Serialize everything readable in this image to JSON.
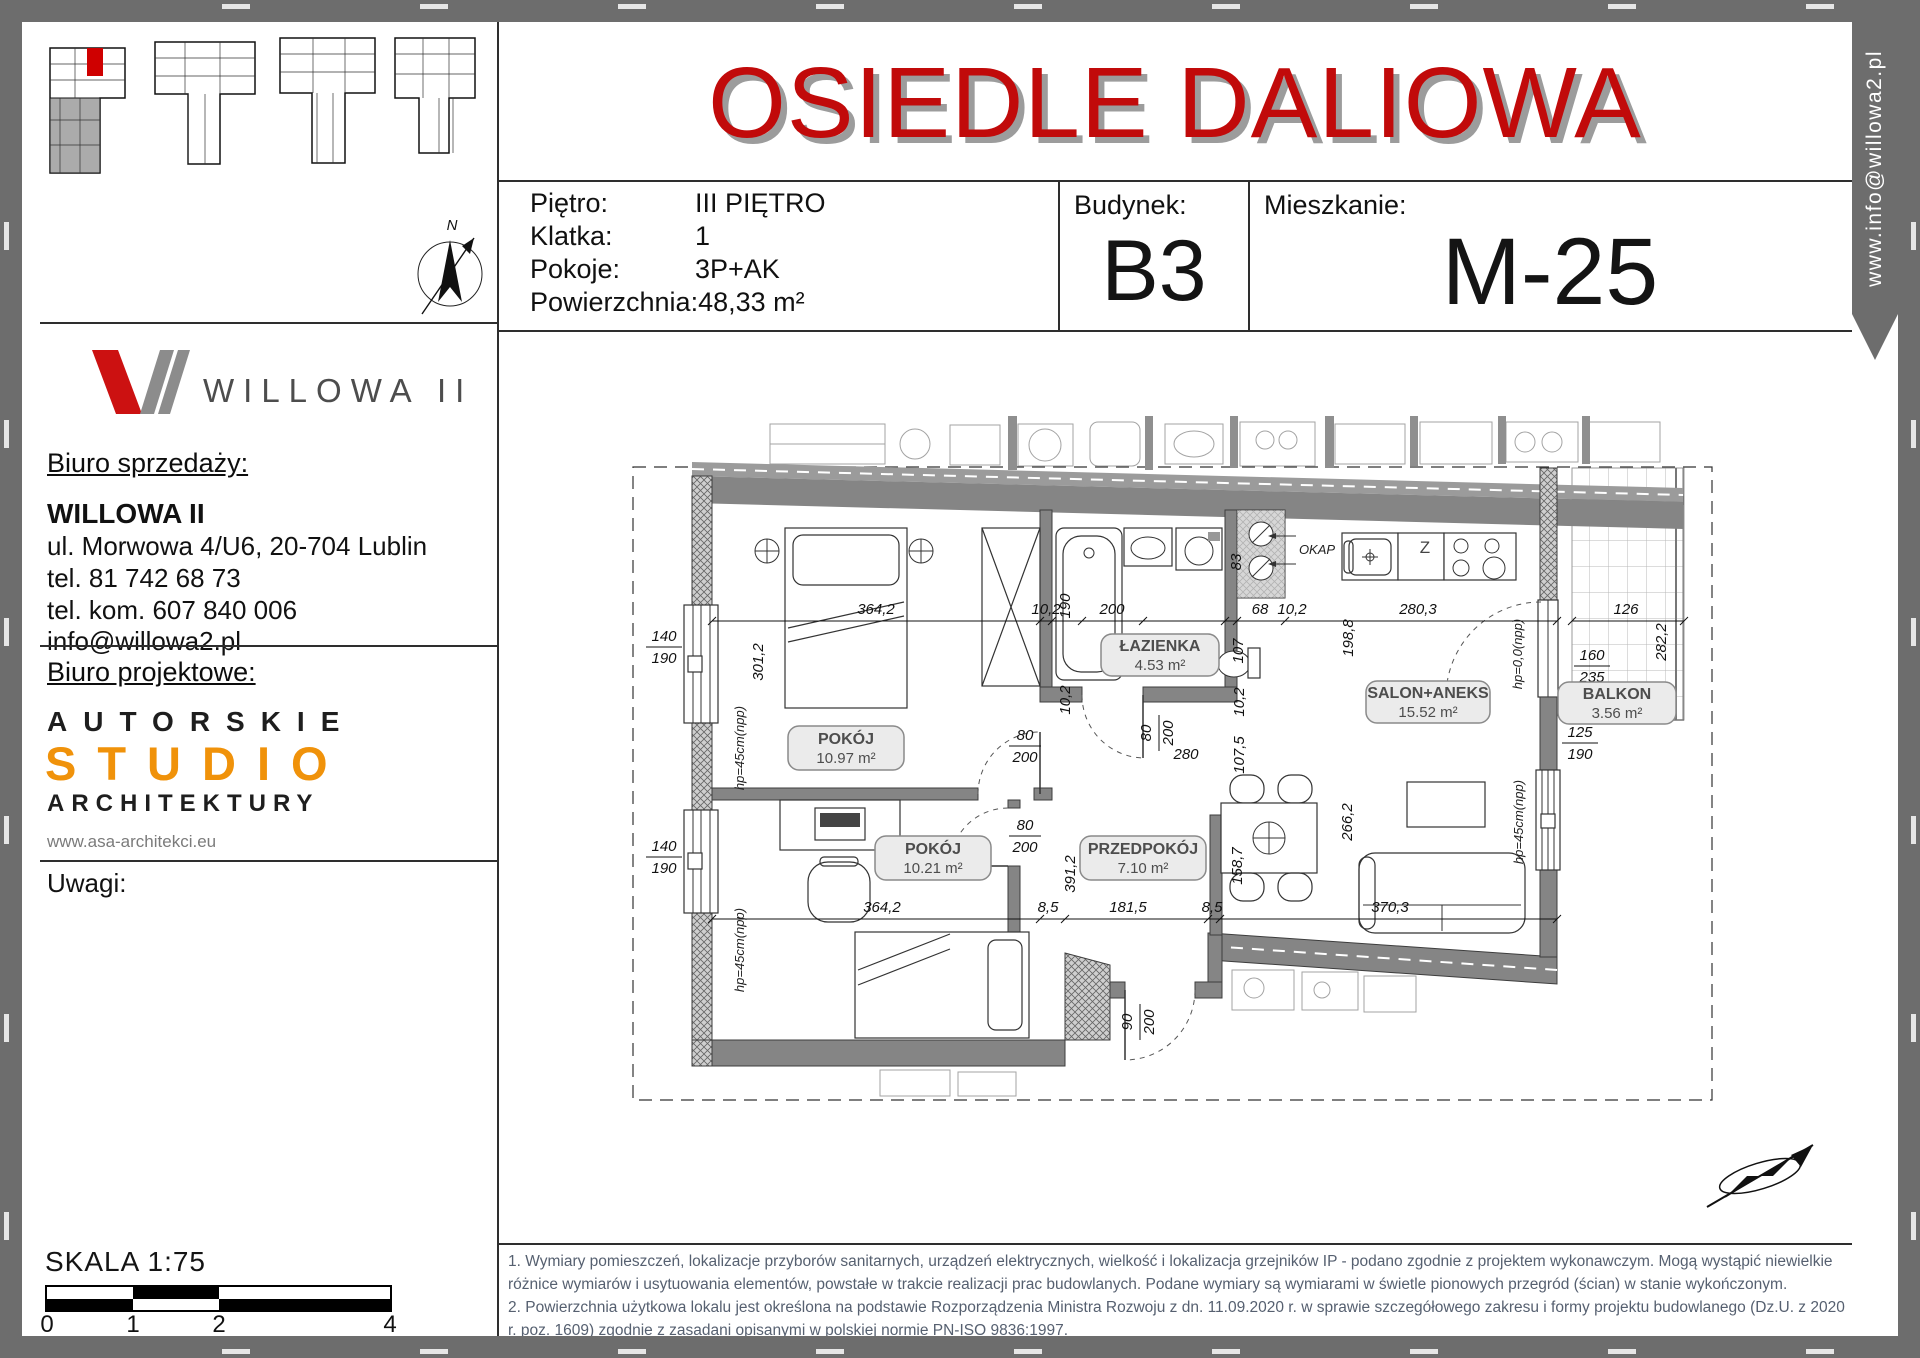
{
  "banner": {
    "text": "www.info@willowa2.pl"
  },
  "header": {
    "title": "OSIEDLE DALIOWA",
    "fields": [
      {
        "label": "Piętro:",
        "value": "III PIĘTRO"
      },
      {
        "label": "Klatka:",
        "value": "1"
      },
      {
        "label": "Pokoje:",
        "value": "3P+AK"
      },
      {
        "label": "Powierzchnia:",
        "value": "48,33 m²"
      }
    ],
    "building": {
      "label": "Budynek:",
      "value": "B3"
    },
    "apartment": {
      "label": "Mieszkanie:",
      "value": "M-25"
    }
  },
  "sidebar": {
    "logo_text": "WILLOWA II",
    "sales": {
      "heading": "Biuro sprzedaży:",
      "company": "WILLOWA II",
      "address": "ul. Morwowa 4/U6, 20-704 Lublin",
      "phone1": "tel. 81 742 68 73",
      "phone2": "tel. kom. 607 840 006",
      "email": "info@willowa2.pl"
    },
    "design": {
      "heading": "Biuro projektowe:",
      "line1": "AUTORSKIE",
      "line2": "STUDIO",
      "line3": "ARCHITEKTURY",
      "website": "www.asa-architekci.eu"
    },
    "notes_label": "Uwagi:",
    "compass_n": "N",
    "scale": {
      "label": "SKALA 1:75",
      "ticks": [
        "0",
        "1",
        "2",
        "4"
      ]
    }
  },
  "plan": {
    "rooms": [
      {
        "name": "POKÓJ",
        "area": "10.97 m²"
      },
      {
        "name": "POKÓJ",
        "area": "10.21 m²"
      },
      {
        "name": "ŁAZIENKA",
        "area": "4.53 m²"
      },
      {
        "name": "PRZEDPOKÓJ",
        "area": "7.10 m²"
      },
      {
        "name": "SALON+ANEKS",
        "area": "15.52 m²"
      },
      {
        "name": "BALKON",
        "area": "3.56 m²"
      }
    ],
    "annotations": {
      "okap": "OKAP",
      "sink": "Z",
      "hp45": "hp=45cm(npp)",
      "hp0": "hp=0,0(npp)"
    },
    "dims": {
      "t364": "364,2",
      "t10a": "10,2",
      "t190": "190",
      "t200": "200",
      "t68": "68",
      "t10b": "10,2",
      "t280": "280,3",
      "t126": "126",
      "v301": "301,2",
      "v198": "198,8",
      "v282": "282,2",
      "v83": "83",
      "v107": "107",
      "v107_5": "107,5",
      "v10": "10,2",
      "v158": "158,7",
      "v391": "391,2",
      "v266": "266,2",
      "b364": "364,2",
      "b8a": "8,5",
      "b181": "181,5",
      "b8b": "8,5",
      "b370": "370,3",
      "win_w": "140",
      "win_h": "190",
      "bal_w": "160",
      "bal_h": "235",
      "sal_w": "125",
      "sal_h": "190",
      "door_w": "80",
      "door_h": "200",
      "hall": "280",
      "ent_w": "90"
    }
  },
  "footer": {
    "notes": [
      "1. Wymiary pomieszczeń, lokalizacje przyborów sanitarnych, urządzeń elektrycznych, wielkość i lokalizacja grzejników IP - podano zgodnie z projektem wykonawczym. Mogą wystąpić niewielkie różnice wymiarów i usytuowania elementów, powstałe w trakcie realizacji prac budowlanych. Podane wymiary są wymiarami w świetle pionowych przegród (ścian) w stanie wykończonym.",
      "2. Powierzchnia użytkowa lokalu jest określona na podstawie Rozporządzenia Ministra Rozwoju z dn. 11.09.2020 r. w sprawie szczegółowego zakresu i formy projektu budowlanego (Dz.U. z 2020 r. poz. 1609) zgodnie z zasadani opisanymi w polskiej normie PN-ISO 9836:1997."
    ]
  },
  "colors": {
    "title_red": "#c10a0a",
    "studio_orange": "#f0920a",
    "wall_gray": "#858585",
    "frame_gray": "#6d6d6d"
  }
}
